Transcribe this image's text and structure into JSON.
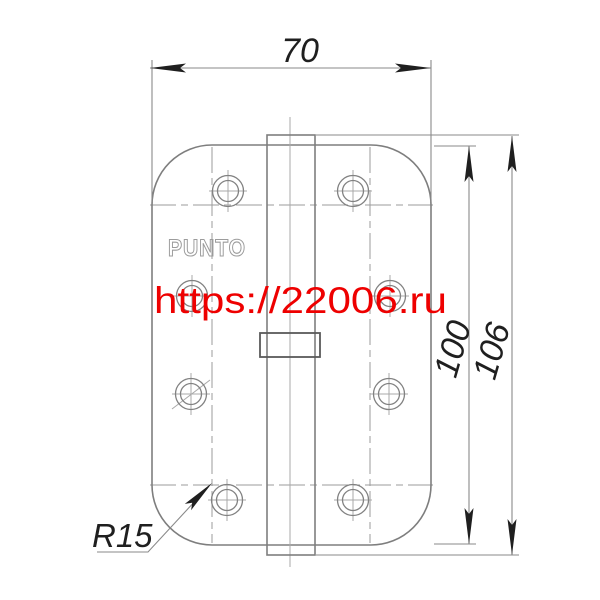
{
  "drawing": {
    "brand_label": "PUNTO",
    "watermark_text": "https://22006.ru",
    "dimensions": {
      "width": "70",
      "leaf_height": "100",
      "overall_height": "106",
      "corner_radius": "R15"
    },
    "colors": {
      "drawing_line": "#7e7e7e",
      "dimension_text": "#1f1f1f",
      "watermark_red": "#ee0000",
      "brand_outline": "#9c9c9c"
    }
  }
}
